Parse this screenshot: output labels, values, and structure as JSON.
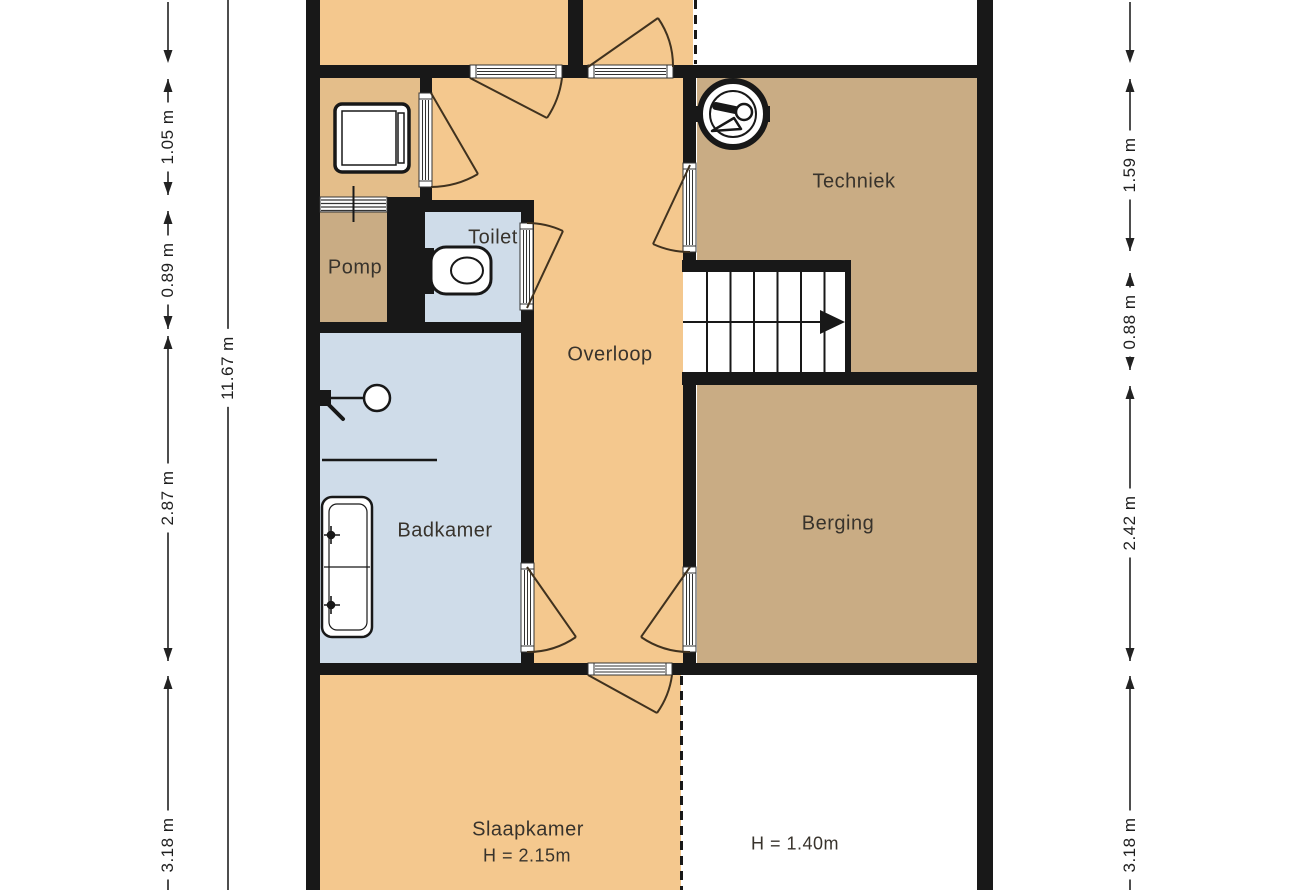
{
  "rooms": {
    "techniek": {
      "label": "Techniek"
    },
    "toilet": {
      "label": "Toilet"
    },
    "pomp": {
      "label": "Pomp"
    },
    "overloop": {
      "label": "Overloop"
    },
    "badkamer": {
      "label": "Badkamer"
    },
    "berging": {
      "label": "Berging"
    },
    "slaapkamer": {
      "label": "Slaapkamer",
      "height_note": "H = 2.15m"
    },
    "attic_low": {
      "height_note": "H = 1.40m"
    }
  },
  "dimensions": {
    "left": [
      "1.05 m",
      "0.89 m",
      "2.87 m",
      "3.18 m"
    ],
    "left_total": "11.67 m",
    "right": [
      "1.59 m",
      "0.88 m",
      "2.42 m",
      "3.18 m"
    ]
  },
  "icons": [
    "washing-machine-icon",
    "boiler-icon",
    "toilet-icon",
    "shower-icon",
    "double-sink-icon",
    "stairs-icon"
  ],
  "colors": {
    "wall": "#181818",
    "room_orange": "#F4C88E",
    "room_alcove": "#E4BE8A",
    "room_tan": "#C9AC84",
    "room_blue": "#CFDCE9",
    "dimension_text": "#1f1f1f"
  }
}
